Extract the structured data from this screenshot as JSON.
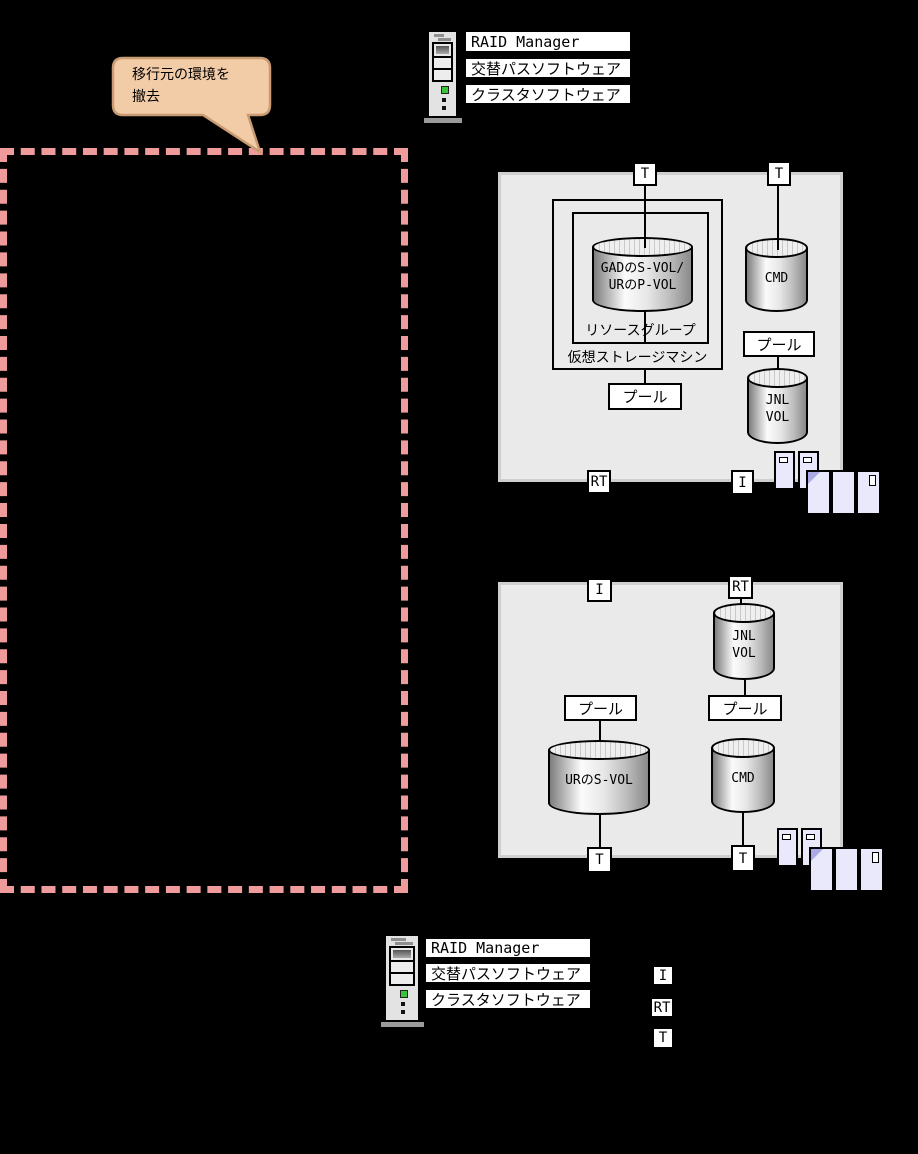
{
  "callout": {
    "text": "移行元の環境を\n撤去"
  },
  "hosts": {
    "top": {
      "software": [
        "RAID Manager",
        "交替パスソフトウェア",
        "クラスタソフトウェア"
      ]
    },
    "bottom": {
      "software": [
        "RAID Manager",
        "交替パスソフトウェア",
        "クラスタソフトウェア"
      ]
    }
  },
  "storage_primary": {
    "ports": {
      "t1": "T",
      "t2": "T",
      "rt": "RT",
      "i": "I"
    },
    "vsm_label": "仮想ストレージマシン",
    "resource_group_label": "リソースグループ",
    "volumes": {
      "gad_ur": "GADのS-VOL/\nURのP-VOL",
      "cmd": "CMD",
      "jnl": "JNL\nVOL"
    },
    "pool_labels": [
      "プール",
      "プール"
    ]
  },
  "storage_secondary": {
    "ports": {
      "i": "I",
      "rt": "RT",
      "t1": "T",
      "t2": "T"
    },
    "volumes": {
      "ur_svol": "URのS-VOL",
      "cmd": "CMD",
      "jnl": "JNL\nVOL"
    },
    "pool_labels": [
      "プール",
      "プール"
    ]
  },
  "legend": {
    "items": [
      "I",
      "RT",
      "T"
    ]
  },
  "colors": {
    "dashed_box": "#F09B9B",
    "callout_fill": "#F2CBA7",
    "callout_border": "#C99B72",
    "storage_box_fill": "#EAEAEA",
    "array_fill": "#E9E9FB"
  }
}
